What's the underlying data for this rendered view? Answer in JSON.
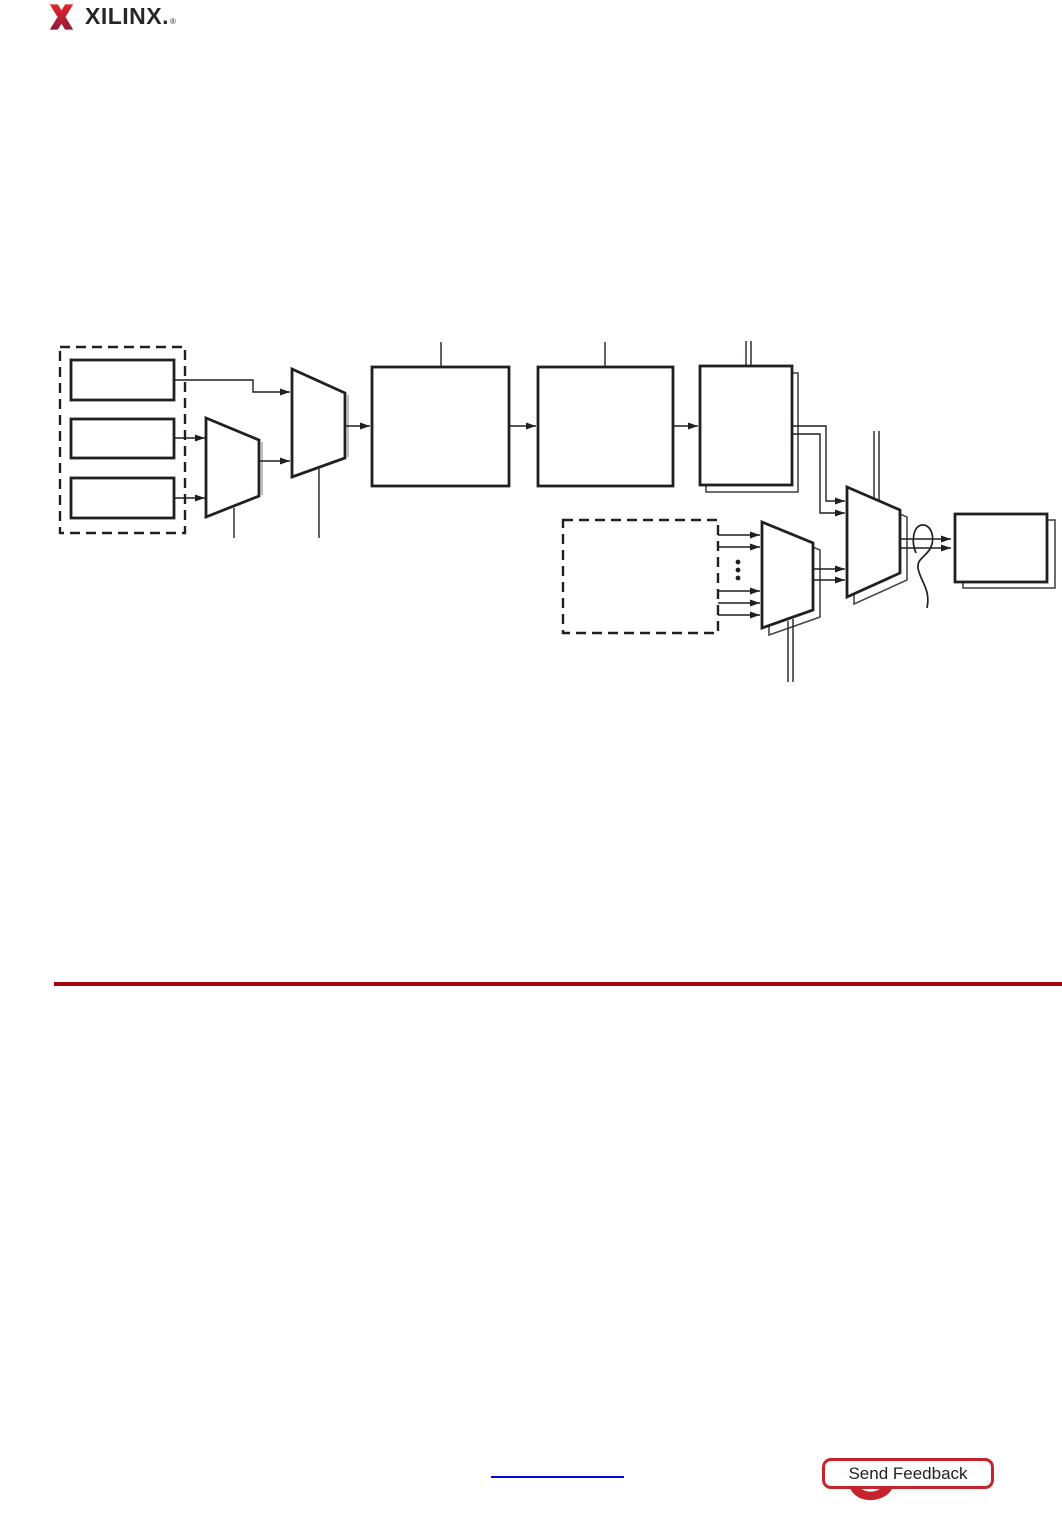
{
  "page": {
    "width_px": 1062,
    "height_px": 1516,
    "background": "#FFFFFF"
  },
  "logo": {
    "brand": "XILINX.",
    "registered": "®"
  },
  "colors": {
    "ink": "#231f20",
    "brand-text": "#2a2627",
    "logo-red-top": "#e9242d",
    "logo-red-bottom": "#8e1b3b",
    "rule-red": "#a10310",
    "link-blue": "#0009cc",
    "feedback-red": "#c5242c",
    "feedback-text": "#232020"
  },
  "figure": {
    "kind": "unlabeled block diagram",
    "dashed_groups": 2,
    "input_registers": 3,
    "muxes": 4,
    "process_blocks": 3,
    "shadowed_blocks": 4,
    "ellipsis_dots": 3,
    "wire_bundle_loop": 1
  },
  "footer": {
    "feedback_label": "Send Feedback"
  }
}
